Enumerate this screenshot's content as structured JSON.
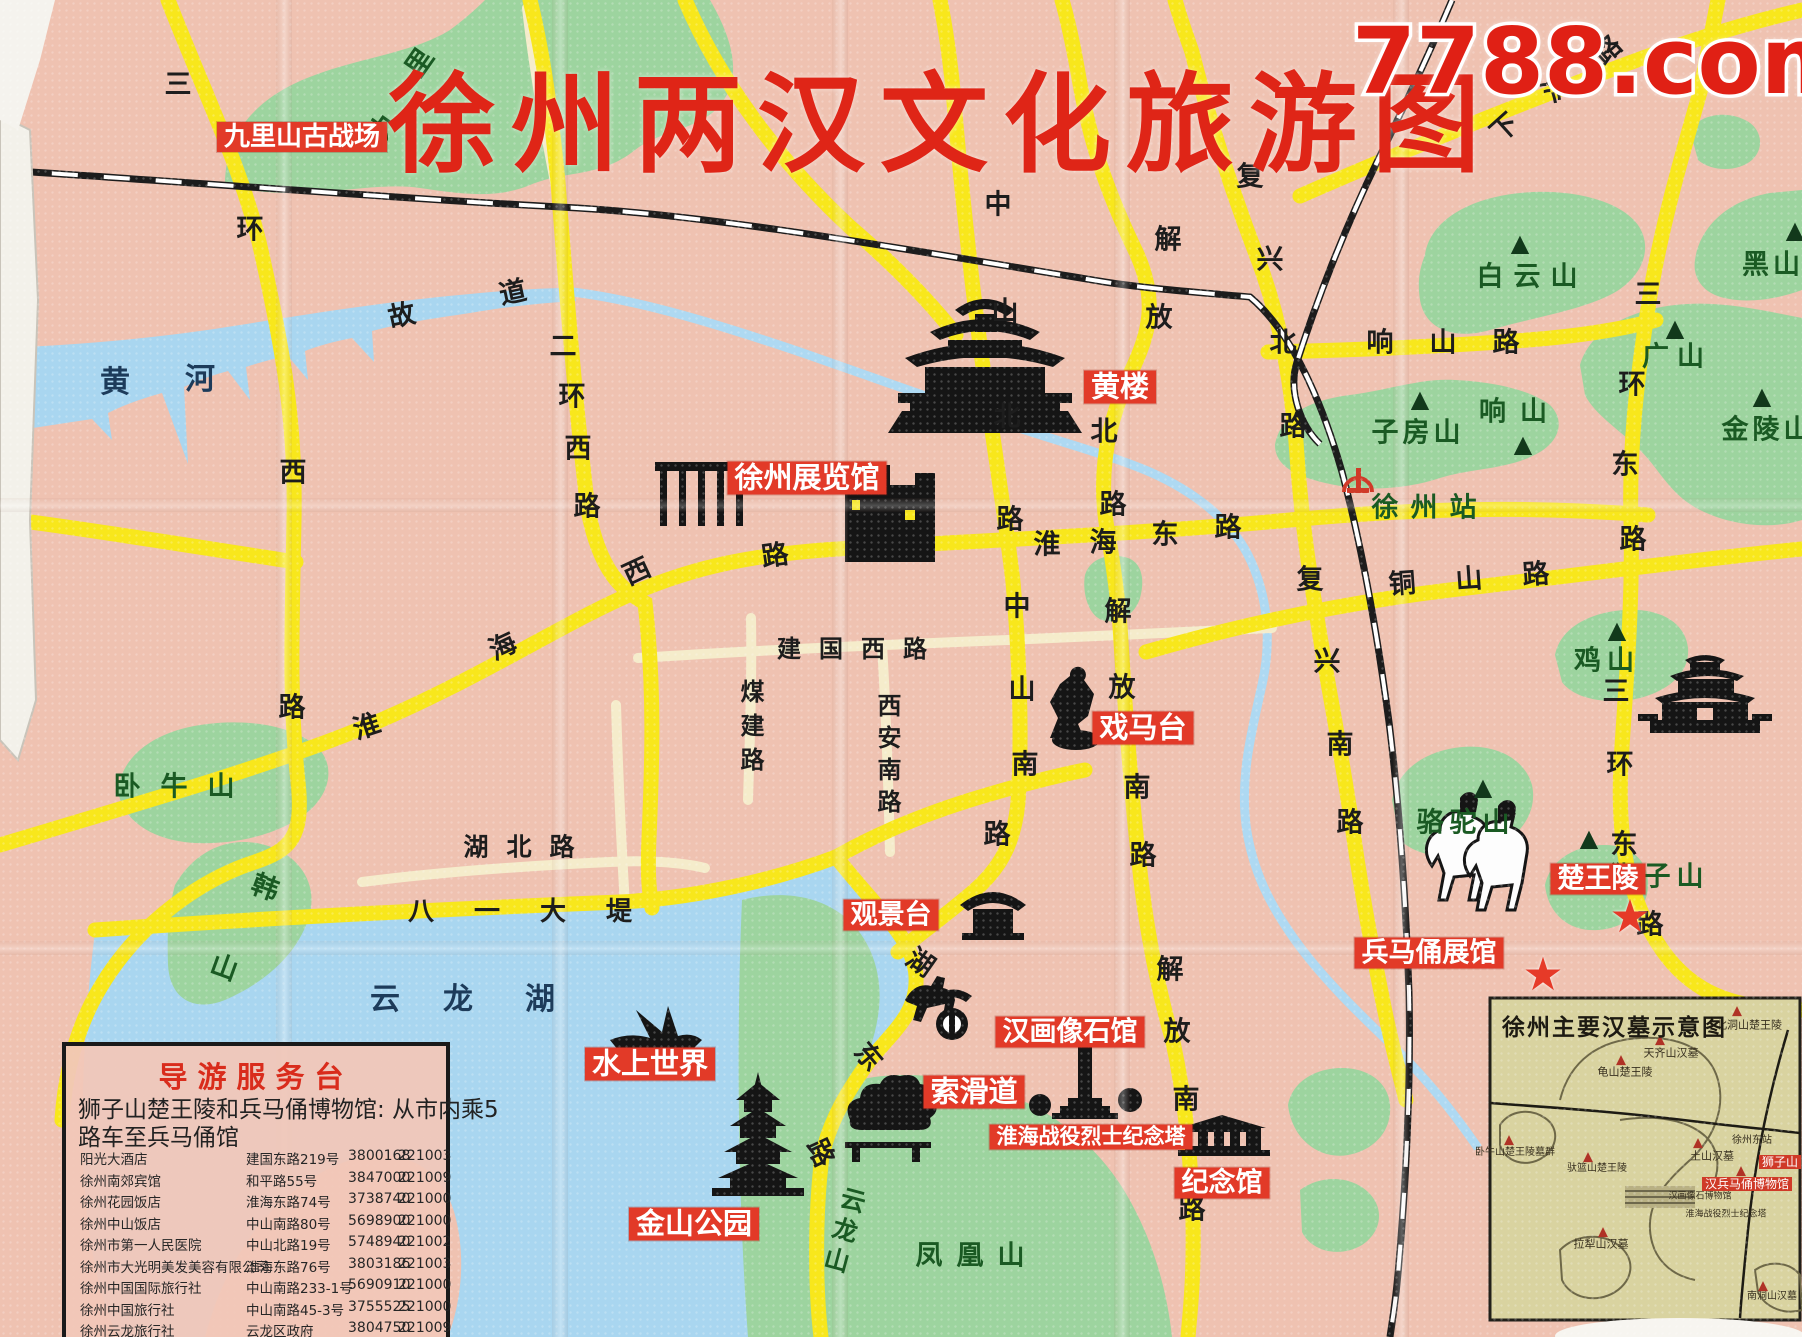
{
  "watermark": "7788.com",
  "map": {
    "title": "徐州两汉文化旅游图",
    "colors": {
      "paper": "#efc2b1",
      "road_yellow": "#f8e71c",
      "road_minor": "#f5eccb",
      "water": "#a9d6f0",
      "green": "#9dd49f",
      "poi_red": "#e23a28",
      "rail_black": "#1c1c1c"
    }
  },
  "legend_names": {
    "roads": [
      "三环西路",
      "二环西路",
      "淮海西路",
      "淮海东路",
      "建国西路",
      "煤建路",
      "西安南路",
      "中山北路",
      "中山南路",
      "解放北路",
      "解放南路",
      "复兴北路",
      "复兴南路",
      "响山路",
      "铜山路",
      "三环东路",
      "下淀路",
      "湖北路",
      "八一大堤",
      "湖东路",
      "故道"
    ],
    "mountains": [
      "九里山",
      "白云山",
      "黑山",
      "广山",
      "金陵山",
      "响山",
      "子房山",
      "鸡山",
      "骆驼山",
      "狮子山",
      "卧牛山",
      "韩山",
      "云龙山",
      "凤凰山"
    ],
    "waters": [
      "黄河",
      "云龙湖"
    ],
    "stations": [
      "徐州站"
    ],
    "pois": [
      "九里山古战场",
      "黄楼",
      "徐州展览馆",
      "戏马台",
      "观景台",
      "水上世界",
      "金山公园",
      "索滑道",
      "汉画像石馆",
      "淮海战役烈士纪念塔",
      "纪念馆",
      "兵马俑展馆",
      "楚王陵"
    ]
  },
  "labels": [
    {
      "t": "三",
      "x": 178,
      "y": 85,
      "c": "r"
    },
    {
      "t": "环",
      "x": 250,
      "y": 230,
      "c": "r"
    },
    {
      "t": "西",
      "x": 293,
      "y": 473,
      "c": "r"
    },
    {
      "t": "路",
      "x": 292,
      "y": 708,
      "c": "r"
    },
    {
      "t": "二",
      "x": 563,
      "y": 347,
      "c": "r"
    },
    {
      "t": "环",
      "x": 572,
      "y": 397,
      "c": "r"
    },
    {
      "t": "西",
      "x": 578,
      "y": 449,
      "c": "r"
    },
    {
      "t": "路",
      "x": 587,
      "y": 507,
      "c": "r"
    },
    {
      "t": "故",
      "x": 402,
      "y": 316,
      "c": "r",
      "rot": -12
    },
    {
      "t": "道",
      "x": 513,
      "y": 293,
      "c": "r",
      "rot": -12
    },
    {
      "t": "淮",
      "x": 367,
      "y": 727,
      "c": "r",
      "rot": -18
    },
    {
      "t": "海",
      "x": 503,
      "y": 647,
      "c": "r",
      "rot": -25
    },
    {
      "t": "西",
      "x": 637,
      "y": 572,
      "c": "r",
      "rot": -25
    },
    {
      "t": "路",
      "x": 775,
      "y": 556,
      "c": "r",
      "rot": -8
    },
    {
      "t": "建国西路",
      "x": 861,
      "y": 649,
      "c": "r",
      "fs": 24,
      "ls": 18
    },
    {
      "t": "煤建路",
      "x": 750,
      "y": 730,
      "c": "r",
      "fs": 24,
      "v": true,
      "ls": 10
    },
    {
      "t": "西安南路",
      "x": 887,
      "y": 757,
      "c": "r",
      "fs": 24,
      "v": true,
      "ls": 8
    },
    {
      "t": "中",
      "x": 998,
      "y": 205,
      "c": "r"
    },
    {
      "t": "山",
      "x": 1005,
      "y": 312,
      "c": "r"
    },
    {
      "t": "北",
      "x": 1007,
      "y": 417,
      "c": "r"
    },
    {
      "t": "路",
      "x": 1010,
      "y": 520,
      "c": "r"
    },
    {
      "t": "中",
      "x": 1017,
      "y": 607,
      "c": "r"
    },
    {
      "t": "山",
      "x": 1022,
      "y": 690,
      "c": "r"
    },
    {
      "t": "南",
      "x": 1025,
      "y": 765,
      "c": "r"
    },
    {
      "t": "路",
      "x": 997,
      "y": 835,
      "c": "r"
    },
    {
      "t": "解",
      "x": 1168,
      "y": 240,
      "c": "r"
    },
    {
      "t": "放",
      "x": 1159,
      "y": 318,
      "c": "r"
    },
    {
      "t": "北",
      "x": 1104,
      "y": 432,
      "c": "r"
    },
    {
      "t": "路",
      "x": 1113,
      "y": 505,
      "c": "r"
    },
    {
      "t": "解",
      "x": 1118,
      "y": 612,
      "c": "r"
    },
    {
      "t": "放",
      "x": 1122,
      "y": 688,
      "c": "r"
    },
    {
      "t": "南",
      "x": 1137,
      "y": 788,
      "c": "r"
    },
    {
      "t": "路",
      "x": 1143,
      "y": 856,
      "c": "r"
    },
    {
      "t": "解",
      "x": 1170,
      "y": 970,
      "c": "r"
    },
    {
      "t": "放",
      "x": 1177,
      "y": 1032,
      "c": "r"
    },
    {
      "t": "南",
      "x": 1186,
      "y": 1100,
      "c": "r"
    },
    {
      "t": "路",
      "x": 1192,
      "y": 1210,
      "c": "r"
    },
    {
      "t": "复",
      "x": 1250,
      "y": 177,
      "c": "r"
    },
    {
      "t": "兴",
      "x": 1270,
      "y": 260,
      "c": "r"
    },
    {
      "t": "北",
      "x": 1283,
      "y": 343,
      "c": "r"
    },
    {
      "t": "路",
      "x": 1293,
      "y": 427,
      "c": "r"
    },
    {
      "t": "复",
      "x": 1310,
      "y": 580,
      "c": "r"
    },
    {
      "t": "兴",
      "x": 1327,
      "y": 662,
      "c": "r"
    },
    {
      "t": "南",
      "x": 1340,
      "y": 745,
      "c": "r"
    },
    {
      "t": "路",
      "x": 1350,
      "y": 823,
      "c": "r"
    },
    {
      "t": "淮",
      "x": 1047,
      "y": 545,
      "c": "r"
    },
    {
      "t": "海",
      "x": 1103,
      "y": 543,
      "c": "r"
    },
    {
      "t": "东",
      "x": 1165,
      "y": 535,
      "c": "r"
    },
    {
      "t": "路",
      "x": 1228,
      "y": 528,
      "c": "r"
    },
    {
      "t": "响山路",
      "x": 1461,
      "y": 343,
      "c": "r",
      "ls": 36
    },
    {
      "t": "铜山路",
      "x": 1489,
      "y": 578,
      "c": "r",
      "ls": 40,
      "rot": -4
    },
    {
      "t": "三",
      "x": 1648,
      "y": 295,
      "c": "r"
    },
    {
      "t": "环",
      "x": 1632,
      "y": 385,
      "c": "r"
    },
    {
      "t": "东",
      "x": 1625,
      "y": 465,
      "c": "r"
    },
    {
      "t": "路",
      "x": 1633,
      "y": 540,
      "c": "r"
    },
    {
      "t": "三",
      "x": 1616,
      "y": 692,
      "c": "r"
    },
    {
      "t": "环",
      "x": 1620,
      "y": 765,
      "c": "r"
    },
    {
      "t": "东",
      "x": 1624,
      "y": 845,
      "c": "r"
    },
    {
      "t": "路",
      "x": 1650,
      "y": 925,
      "c": "r"
    },
    {
      "t": "湖北路",
      "x": 528,
      "y": 847,
      "c": "r",
      "fs": 25,
      "ls": 18
    },
    {
      "t": "八一大堤",
      "x": 540,
      "y": 912,
      "c": "r",
      "fs": 26,
      "ls": 40
    },
    {
      "t": "湖",
      "x": 920,
      "y": 963,
      "c": "r",
      "rot": 35
    },
    {
      "t": "东",
      "x": 868,
      "y": 1057,
      "c": "r",
      "rot": 50
    },
    {
      "t": "路",
      "x": 820,
      "y": 1153,
      "c": "r",
      "rot": 65
    },
    {
      "t": "下",
      "x": 1505,
      "y": 128,
      "c": "r",
      "rot": -42
    },
    {
      "t": "淀",
      "x": 1557,
      "y": 88,
      "c": "r",
      "rot": -42
    },
    {
      "t": "路",
      "x": 1608,
      "y": 50,
      "c": "r",
      "rot": -42
    },
    {
      "t": "黄",
      "x": 115,
      "y": 383,
      "c": "w"
    },
    {
      "t": "河",
      "x": 200,
      "y": 380,
      "c": "w"
    },
    {
      "t": "云",
      "x": 385,
      "y": 1000,
      "c": "w"
    },
    {
      "t": "龙",
      "x": 458,
      "y": 1000,
      "c": "w"
    },
    {
      "t": "湖",
      "x": 540,
      "y": 1000,
      "c": "w"
    },
    {
      "t": "九",
      "x": 385,
      "y": 125,
      "c": "m",
      "rot": -55
    },
    {
      "t": "里",
      "x": 420,
      "y": 63,
      "c": "m",
      "rot": -55
    },
    {
      "t": "白云山",
      "x": 1532,
      "y": 277,
      "c": "m",
      "ls": 10
    },
    {
      "t": "黑山",
      "x": 1773,
      "y": 265,
      "c": "m",
      "ls": 4
    },
    {
      "t": "广山",
      "x": 1677,
      "y": 357,
      "c": "m",
      "ls": 8
    },
    {
      "t": "金陵山",
      "x": 1768,
      "y": 430,
      "c": "m",
      "ls": 4
    },
    {
      "t": "响山",
      "x": 1520,
      "y": 412,
      "c": "m",
      "ls": 14
    },
    {
      "t": "子房山",
      "x": 1418,
      "y": 433,
      "c": "m",
      "ls": 4
    },
    {
      "t": "鸡山",
      "x": 1607,
      "y": 661,
      "c": "m",
      "ls": 6
    },
    {
      "t": "骆驼山",
      "x": 1466,
      "y": 823,
      "c": "m",
      "ls": 6
    },
    {
      "t": "狮子山",
      "x": 1660,
      "y": 877,
      "c": "m",
      "ls": 6
    },
    {
      "t": "卧牛山",
      "x": 184,
      "y": 787,
      "c": "m",
      "ls": 20
    },
    {
      "t": "韩",
      "x": 265,
      "y": 888,
      "c": "m",
      "rot": 20
    },
    {
      "t": "山",
      "x": 224,
      "y": 968,
      "c": "m",
      "rot": 20
    },
    {
      "t": "云龙山",
      "x": 843,
      "y": 1232,
      "c": "m",
      "fs": 25,
      "v": true,
      "ls": 6,
      "rot": 15
    },
    {
      "t": "凤凰山",
      "x": 977,
      "y": 1256,
      "c": "m",
      "ls": 14
    },
    {
      "t": "徐州站",
      "x": 1430,
      "y": 508,
      "c": "m",
      "ls": 12,
      "n": "xuzhou-station-label"
    },
    {
      "t": "▲",
      "x": 1520,
      "y": 243,
      "c": "pk"
    },
    {
      "t": "▲",
      "x": 1795,
      "y": 230,
      "c": "pk"
    },
    {
      "t": "▲",
      "x": 1675,
      "y": 328,
      "c": "pk"
    },
    {
      "t": "▲",
      "x": 1762,
      "y": 396,
      "c": "pk"
    },
    {
      "t": "▲",
      "x": 1523,
      "y": 444,
      "c": "pk"
    },
    {
      "t": "▲",
      "x": 1420,
      "y": 399,
      "c": "pk"
    },
    {
      "t": "▲",
      "x": 1617,
      "y": 630,
      "c": "pk"
    },
    {
      "t": "▲",
      "x": 1483,
      "y": 787,
      "c": "pk"
    },
    {
      "t": "▲",
      "x": 1589,
      "y": 838,
      "c": "pk"
    },
    {
      "t": "九里山古战场",
      "x": 302,
      "y": 137,
      "c": "p",
      "fs": 26,
      "n": "poi-jiulishan-battlefield"
    },
    {
      "t": "黄楼",
      "x": 1120,
      "y": 387,
      "c": "p",
      "fs": 29,
      "n": "poi-huanglou"
    },
    {
      "t": "徐州展览馆",
      "x": 807,
      "y": 478,
      "c": "p",
      "fs": 29,
      "n": "poi-exhibition-hall"
    },
    {
      "t": "戏马台",
      "x": 1143,
      "y": 728,
      "c": "p",
      "fs": 29,
      "n": "poi-ximatai"
    },
    {
      "t": "观景台",
      "x": 891,
      "y": 915,
      "c": "p",
      "fs": 27,
      "n": "poi-viewing-platform"
    },
    {
      "t": "水上世界",
      "x": 650,
      "y": 1064,
      "c": "p",
      "fs": 29,
      "n": "poi-water-world"
    },
    {
      "t": "金山公园",
      "x": 694,
      "y": 1224,
      "c": "p",
      "fs": 29,
      "n": "poi-jinshan-park"
    },
    {
      "t": "索滑道",
      "x": 974,
      "y": 1092,
      "c": "p",
      "fs": 29,
      "n": "poi-cableway"
    },
    {
      "t": "汉画像石馆",
      "x": 1070,
      "y": 1032,
      "c": "p",
      "fs": 27,
      "n": "poi-stone-relief-museum"
    },
    {
      "t": "淮海战役烈士纪念塔",
      "x": 1091,
      "y": 1137,
      "c": "p",
      "fs": 21,
      "n": "poi-huaihai-memorial-tower"
    },
    {
      "t": "纪念馆",
      "x": 1222,
      "y": 1183,
      "c": "p",
      "fs": 27,
      "n": "poi-memorial-hall"
    },
    {
      "t": "兵马俑展馆",
      "x": 1429,
      "y": 953,
      "c": "p",
      "fs": 27,
      "n": "poi-terracotta-museum"
    },
    {
      "t": "楚王陵",
      "x": 1598,
      "y": 879,
      "c": "p",
      "fs": 27,
      "n": "poi-chu-king-tomb"
    },
    {
      "t": "★",
      "x": 1630,
      "y": 916,
      "c": "st"
    },
    {
      "t": "★",
      "x": 1543,
      "y": 974,
      "c": "st"
    },
    {
      "t": "北洞山楚王陵",
      "x": 1749,
      "y": 1025,
      "c": "i"
    },
    {
      "t": "天齐山汉墓",
      "x": 1671,
      "y": 1053,
      "c": "i"
    },
    {
      "t": "龟山楚王陵",
      "x": 1625,
      "y": 1072,
      "c": "i"
    },
    {
      "t": "卧牛山楚王陵墓群",
      "x": 1515,
      "y": 1153,
      "c": "i",
      "fs": 10
    },
    {
      "t": "驮篮山楚王陵",
      "x": 1597,
      "y": 1169,
      "c": "i",
      "fs": 10
    },
    {
      "t": "徐州东站",
      "x": 1752,
      "y": 1141,
      "c": "i",
      "fs": 10
    },
    {
      "t": "土山汉墓",
      "x": 1712,
      "y": 1156,
      "c": "i"
    },
    {
      "t": "汉画像石博物馆",
      "x": 1700,
      "y": 1197,
      "c": "i",
      "fs": 9
    },
    {
      "t": "淮海战役烈士纪念塔",
      "x": 1726,
      "y": 1215,
      "c": "i",
      "fs": 9
    },
    {
      "t": "拉犁山汉墓",
      "x": 1601,
      "y": 1244,
      "c": "i"
    },
    {
      "t": "南洞山汉墓",
      "x": 1772,
      "y": 1297,
      "c": "i",
      "fs": 10
    },
    {
      "t": "狮子山",
      "x": 1780,
      "y": 1162,
      "c": "ip"
    },
    {
      "t": "汉兵马俑博物馆",
      "x": 1747,
      "y": 1184,
      "c": "ip"
    },
    {
      "t": "▲",
      "x": 1737,
      "y": 1011,
      "c": "ipk"
    },
    {
      "t": "▲",
      "x": 1660,
      "y": 1040,
      "c": "ipk"
    },
    {
      "t": "▲",
      "x": 1621,
      "y": 1060,
      "c": "ipk"
    },
    {
      "t": "▲",
      "x": 1509,
      "y": 1140,
      "c": "ipk"
    },
    {
      "t": "▲",
      "x": 1588,
      "y": 1157,
      "c": "ipk"
    },
    {
      "t": "▲",
      "x": 1698,
      "y": 1143,
      "c": "ipk"
    },
    {
      "t": "▲",
      "x": 1741,
      "y": 1171,
      "c": "ipk"
    },
    {
      "t": "▲",
      "x": 1603,
      "y": 1232,
      "c": "ipk"
    },
    {
      "t": "▲",
      "x": 1763,
      "y": 1286,
      "c": "ipk"
    }
  ],
  "guide_box": {
    "title": "导游服务台",
    "intro_line1": "狮子山楚王陵和兵马俑博物馆: 从市内乘5",
    "intro_line2": "路车至兵马俑馆",
    "rows": [
      {
        "name": "阳光大酒店",
        "address": "建国东路219号",
        "phone": "3800168",
        "postal": "221003"
      },
      {
        "name": "徐州南郊宾馆",
        "address": "和平路55号",
        "phone": "3847000",
        "postal": "221009"
      },
      {
        "name": "徐州花园饭店",
        "address": "淮海东路74号",
        "phone": "3738740",
        "postal": "221000"
      },
      {
        "name": "徐州中山饭店",
        "address": "中山南路80号",
        "phone": "5698900",
        "postal": "221000"
      },
      {
        "name": "徐州市第一人民医院",
        "address": "中山北路19号",
        "phone": "5748940",
        "postal": "221002"
      },
      {
        "name": "徐州市大光明美发美容有限公司",
        "address": "淮海东路76号",
        "phone": "3803186",
        "postal": "221003"
      },
      {
        "name": "徐州中国国际旅行社",
        "address": "中山南路233-1号",
        "phone": "5690910",
        "postal": "221000"
      },
      {
        "name": "徐州中国旅行社",
        "address": "中山南路45-3号",
        "phone": "3755525",
        "postal": "221000"
      },
      {
        "name": "徐州云龙旅行社",
        "address": "云龙区政府",
        "phone": "3804750",
        "postal": "221009"
      }
    ]
  },
  "inset": {
    "title": "徐州主要汉墓示意图"
  }
}
